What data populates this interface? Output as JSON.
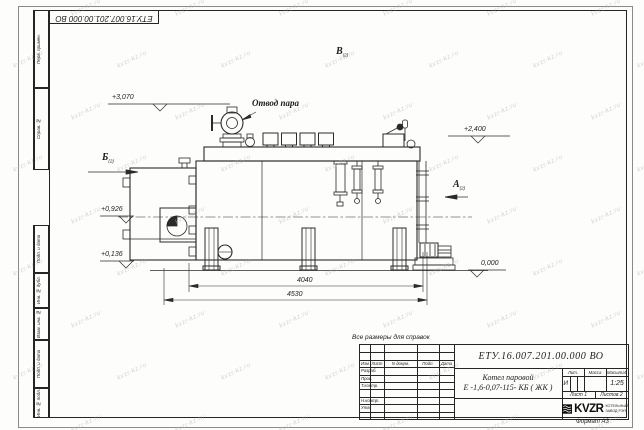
{
  "sheet": {
    "reference_note": "Все размеры для справок",
    "format_label": "Формат А3",
    "watermark_text": "kvzr-kz.ru",
    "line_color": "#2a2a2a",
    "paper_color": "#fdfdfb"
  },
  "corner_stamp": {
    "doc_number": "ЕТУ.16.007.201.00.000  ВО"
  },
  "margin_stamps": {
    "top": [
      "Перв. примен.",
      "Справ. №"
    ],
    "bottom": [
      "Подп. и дата",
      "Инв. № дубл.",
      "Взам. инв. №",
      "Подп. и дата",
      "Инв. № подл."
    ]
  },
  "drawing": {
    "steam_outlet_label": "Отвод пара",
    "views": [
      {
        "letter": "Б",
        "sheet_ref": "(2)"
      },
      {
        "letter": "В",
        "sheet_ref": "(2)"
      },
      {
        "letter": "А",
        "sheet_ref": "(2)"
      }
    ],
    "elevation_marks": [
      "+3,070",
      "+2,400",
      "+0,926",
      "+0,136",
      "0,000"
    ],
    "dimensions": [
      "4040",
      "4530"
    ]
  },
  "title_block": {
    "doc_number": "ЕТУ.16.007.201.00.000  ВО",
    "product_name": [
      "Котел паровой",
      "Е -1,6-0,07-115- КБ ( ЖК )"
    ],
    "revision_header": [
      "Изм",
      "Лист",
      "N докум.",
      "Подп.",
      "Дата"
    ],
    "signature_rows": [
      "Разраб.",
      "Пров.",
      "Т.контр.",
      "",
      "Н.контр.",
      "Утв."
    ],
    "properties_header": [
      "Лит.",
      "Масса",
      "Масштаб"
    ],
    "liter_value": "И",
    "scale": "1:25",
    "sheet_info": {
      "sheet": "Лист 1",
      "total": "Листов 2"
    },
    "company": {
      "logo": "KVZR",
      "name": [
        "КОТЕЛЬНЫЙ",
        "ЗАВОД РЭП"
      ]
    }
  }
}
